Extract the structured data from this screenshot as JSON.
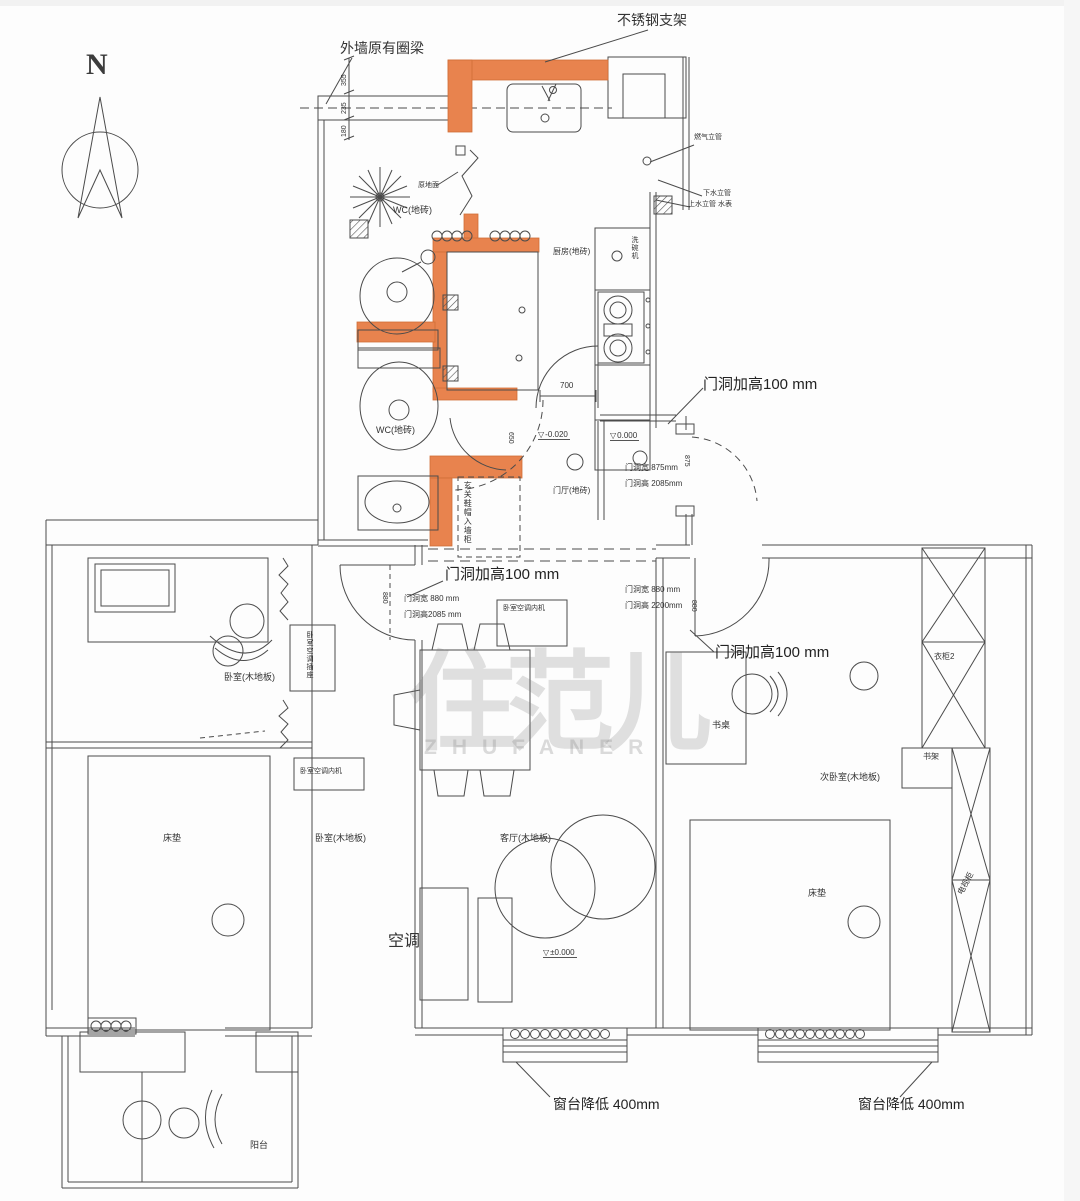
{
  "compass": "N",
  "watermark": {
    "cn": "住范儿",
    "en": "ZHUFANER"
  },
  "colors": {
    "highlight_wall": "#E8834E",
    "line": "#4b4b4b",
    "watermark_gray": "#d8d8d8"
  },
  "top_labels": {
    "ring_beam": "外墙原有圈梁",
    "bracket": "不锈钢支架"
  },
  "risers": {
    "gas": "燃气立管",
    "drain": "下水立管",
    "supply": "上水立管 水表"
  },
  "rooms": {
    "wc": "WC(地砖)",
    "kitchen": "厨房(地砖)",
    "hall": "门厅(地砖)",
    "bedroom": "卧室(木地板)",
    "living": "客厅(木地板)",
    "second_bedroom": "次卧室(木地板)",
    "balcony": "阳台"
  },
  "furniture": {
    "dishwasher": "洗碗机",
    "entry_closet": "玄关鞋帽入墙柜",
    "ac_indoor": "卧室空调内机",
    "ac_socket": "卧室空调插座",
    "mattress": "床垫",
    "desk": "书桌",
    "wardrobe2": "衣柜2",
    "bookshelf": "书架",
    "tv_cabinet": "电视柜",
    "aircon": "空调",
    "orig_floor": "原地面"
  },
  "doors": {
    "raise": "门洞加高100 mm",
    "d1_w": "门洞宽 875mm",
    "d1_h": "门洞高 2085mm",
    "d2_w": "门洞宽 880 mm",
    "d2_h": "门洞高2085 mm",
    "d3_w": "门洞宽 880 mm",
    "d3_h": "门洞高 2200mm"
  },
  "windows": {
    "sill": "窗台降低 400mm"
  },
  "levels": {
    "entry": "-0.020",
    "hall": "0.000",
    "living": "±0.000"
  },
  "dims": {
    "a": "355",
    "b": "235",
    "c": "180",
    "kitchen_door": "700",
    "wc_door": "650",
    "entry_door": "875",
    "bedroom_door": "880"
  }
}
